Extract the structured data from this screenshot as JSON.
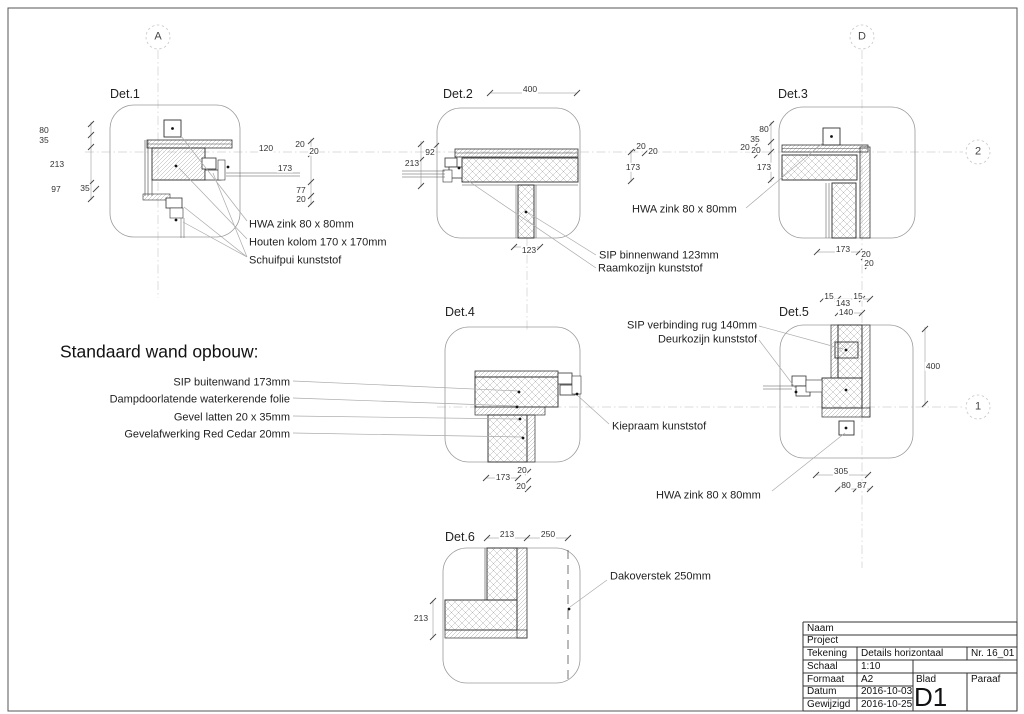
{
  "grid_markers": {
    "a": "A",
    "d": "D",
    "two": "2",
    "one": "1"
  },
  "wall_note": {
    "title": "Standaard wand opbouw:",
    "items": [
      "SIP buitenwand 173mm",
      "Dampdoorlatende waterkerende folie",
      "Gevel latten 20 x 35mm",
      "Gevelafwerking Red Cedar 20mm"
    ]
  },
  "details": {
    "det1": {
      "title": "Det.1",
      "dims": [
        "80",
        "35",
        "213",
        "97",
        "35",
        "120",
        "20",
        "20",
        "173",
        "77",
        "20"
      ],
      "labels": [
        "HWA zink 80 x 80mm",
        "Houten kolom 170 x 170mm",
        "Schuifpui kunststof"
      ]
    },
    "det2": {
      "title": "Det.2",
      "dims": [
        "400",
        "92",
        "213",
        "123",
        "20",
        "20",
        "173"
      ],
      "labels": [
        "SIP binnenwand 123mm",
        "Raamkozijn kunststof",
        "HWA zink 80 x 80mm"
      ]
    },
    "det3": {
      "title": "Det.3",
      "dims": [
        "80",
        "35",
        "20",
        "20",
        "173",
        "173",
        "20",
        "20"
      ]
    },
    "det4": {
      "title": "Det.4",
      "dims": [
        "173",
        "20",
        "20"
      ],
      "labels": [
        "Kiepraam kunststof"
      ]
    },
    "det5": {
      "title": "Det.5",
      "dims": [
        "15",
        "143",
        "15",
        "140",
        "400",
        "305",
        "80",
        "87"
      ],
      "labels": [
        "SIP verbinding rug 140mm",
        "Deurkozijn kunststof",
        "HWA zink 80 x 80mm"
      ]
    },
    "det6": {
      "title": "Det.6",
      "dims": [
        "213",
        "250",
        "213"
      ],
      "labels": [
        "Dakoverstek 250mm"
      ]
    }
  },
  "titleblock": {
    "naam_label": "Naam",
    "project_label": "Project",
    "tekening_label": "Tekening",
    "tekening_value": "Details horizontaal",
    "nr_value": "Nr. 16_01",
    "schaal_label": "Schaal",
    "schaal_value": "1:10",
    "formaat_label": "Formaat",
    "formaat_value": "A2",
    "blad_label": "Blad",
    "paraaf_label": "Paraaf",
    "datum_label": "Datum",
    "datum_value": "2016-10-03",
    "gewijzigd_label": "Gewijzigd",
    "gewijzigd_value": "2016-10-25",
    "blad_value": "D1"
  }
}
